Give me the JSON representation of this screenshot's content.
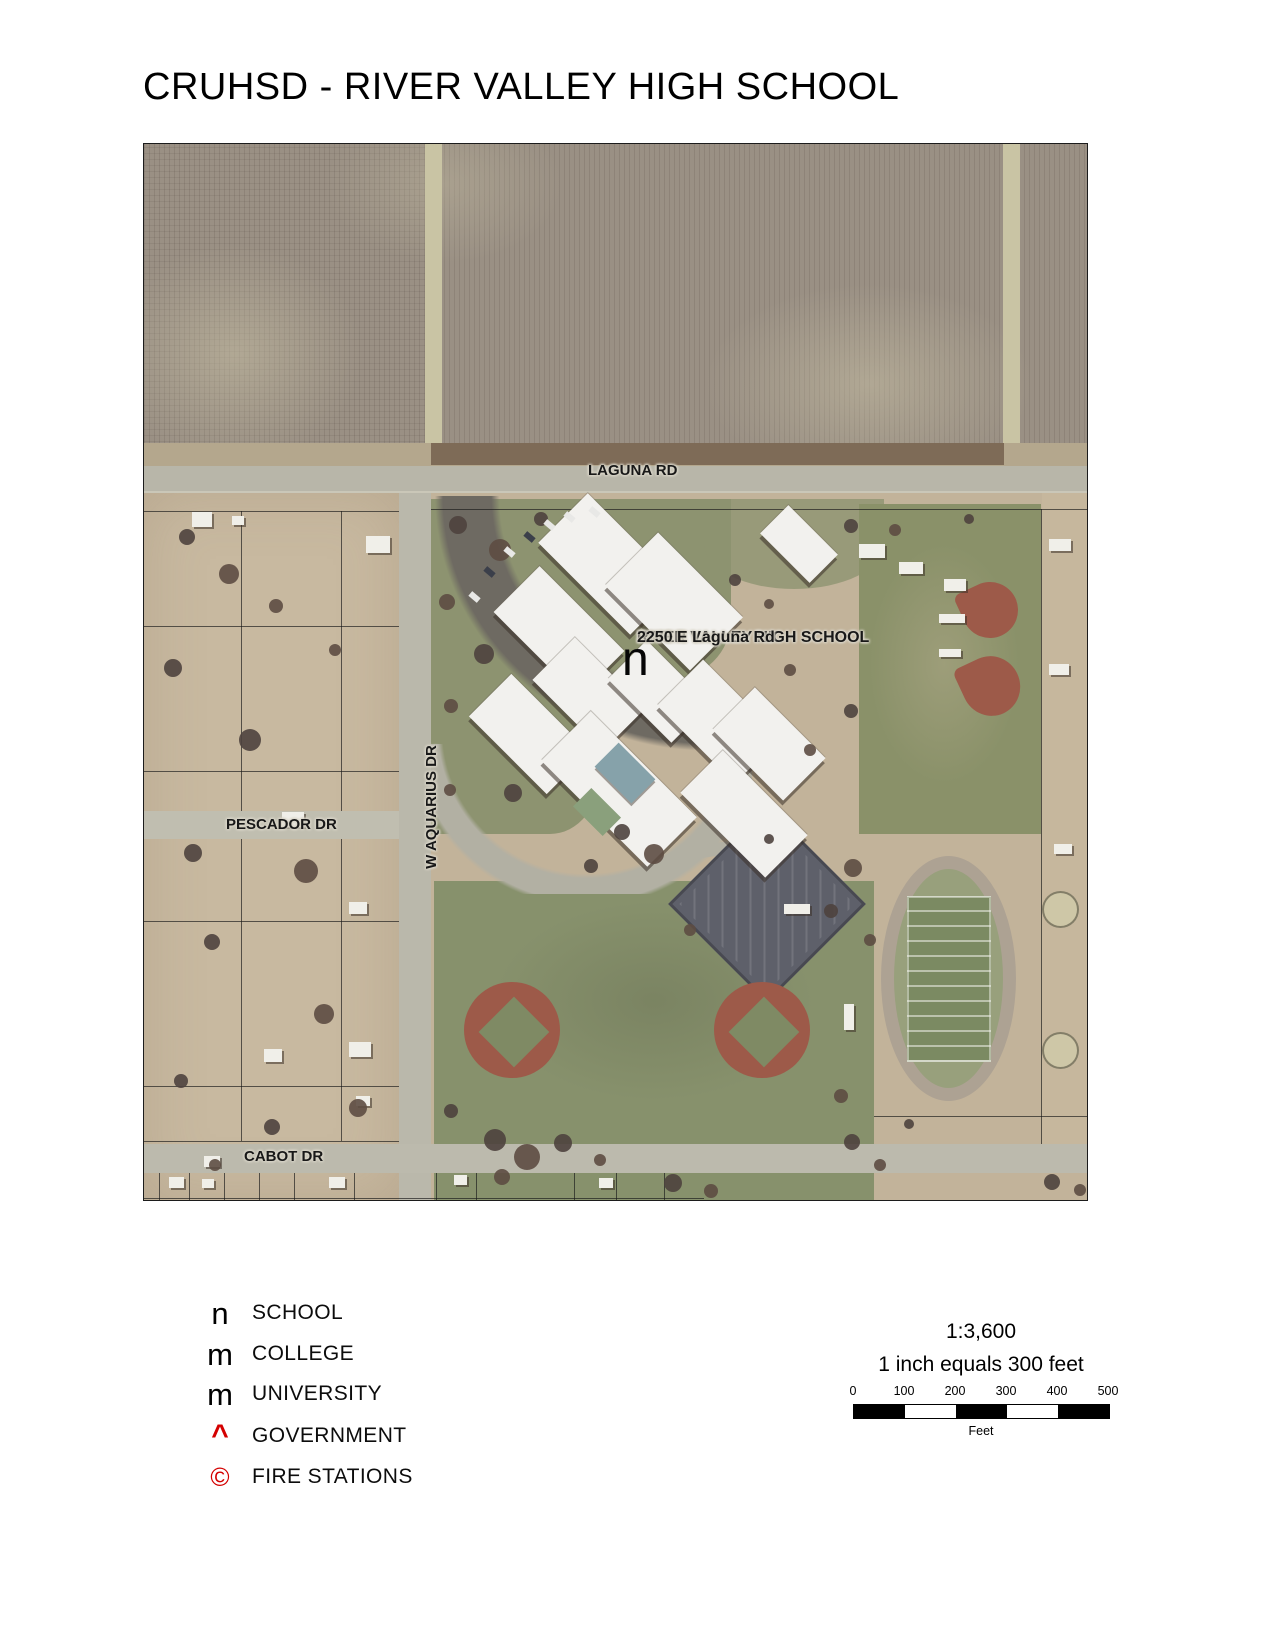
{
  "page": {
    "title": "CRUHSD - RIVER VALLEY HIGH SCHOOL"
  },
  "map": {
    "road_labels": {
      "laguna": "LAGUNA RD",
      "pescador": "PESCADOR DR",
      "aquarius": "W AQUARIUS DR",
      "cabot": "CABOT DR"
    },
    "school_callout": {
      "line1": "RIVER VALLEY HIGH SCHOOL",
      "line2": "2250 E Laguna Rd",
      "marker_glyph": "n"
    }
  },
  "legend": {
    "items": [
      {
        "symbol": "n",
        "label": "SCHOOL",
        "color": "#000000"
      },
      {
        "symbol": "m",
        "label": "COLLEGE",
        "color": "#000000"
      },
      {
        "symbol": "m",
        "label": "UNIVERSITY",
        "color": "#000000"
      },
      {
        "symbol": "^",
        "label": "GOVERNMENT",
        "color": "#d40000"
      },
      {
        "symbol": "©",
        "label": "FIRE STATIONS",
        "color": "#d40000"
      }
    ]
  },
  "scale": {
    "ratio": "1:3,600",
    "equivalence": "1 inch equals 300 feet",
    "ticks": [
      "0",
      "100",
      "200",
      "300",
      "400",
      "500"
    ],
    "unit": "Feet"
  }
}
